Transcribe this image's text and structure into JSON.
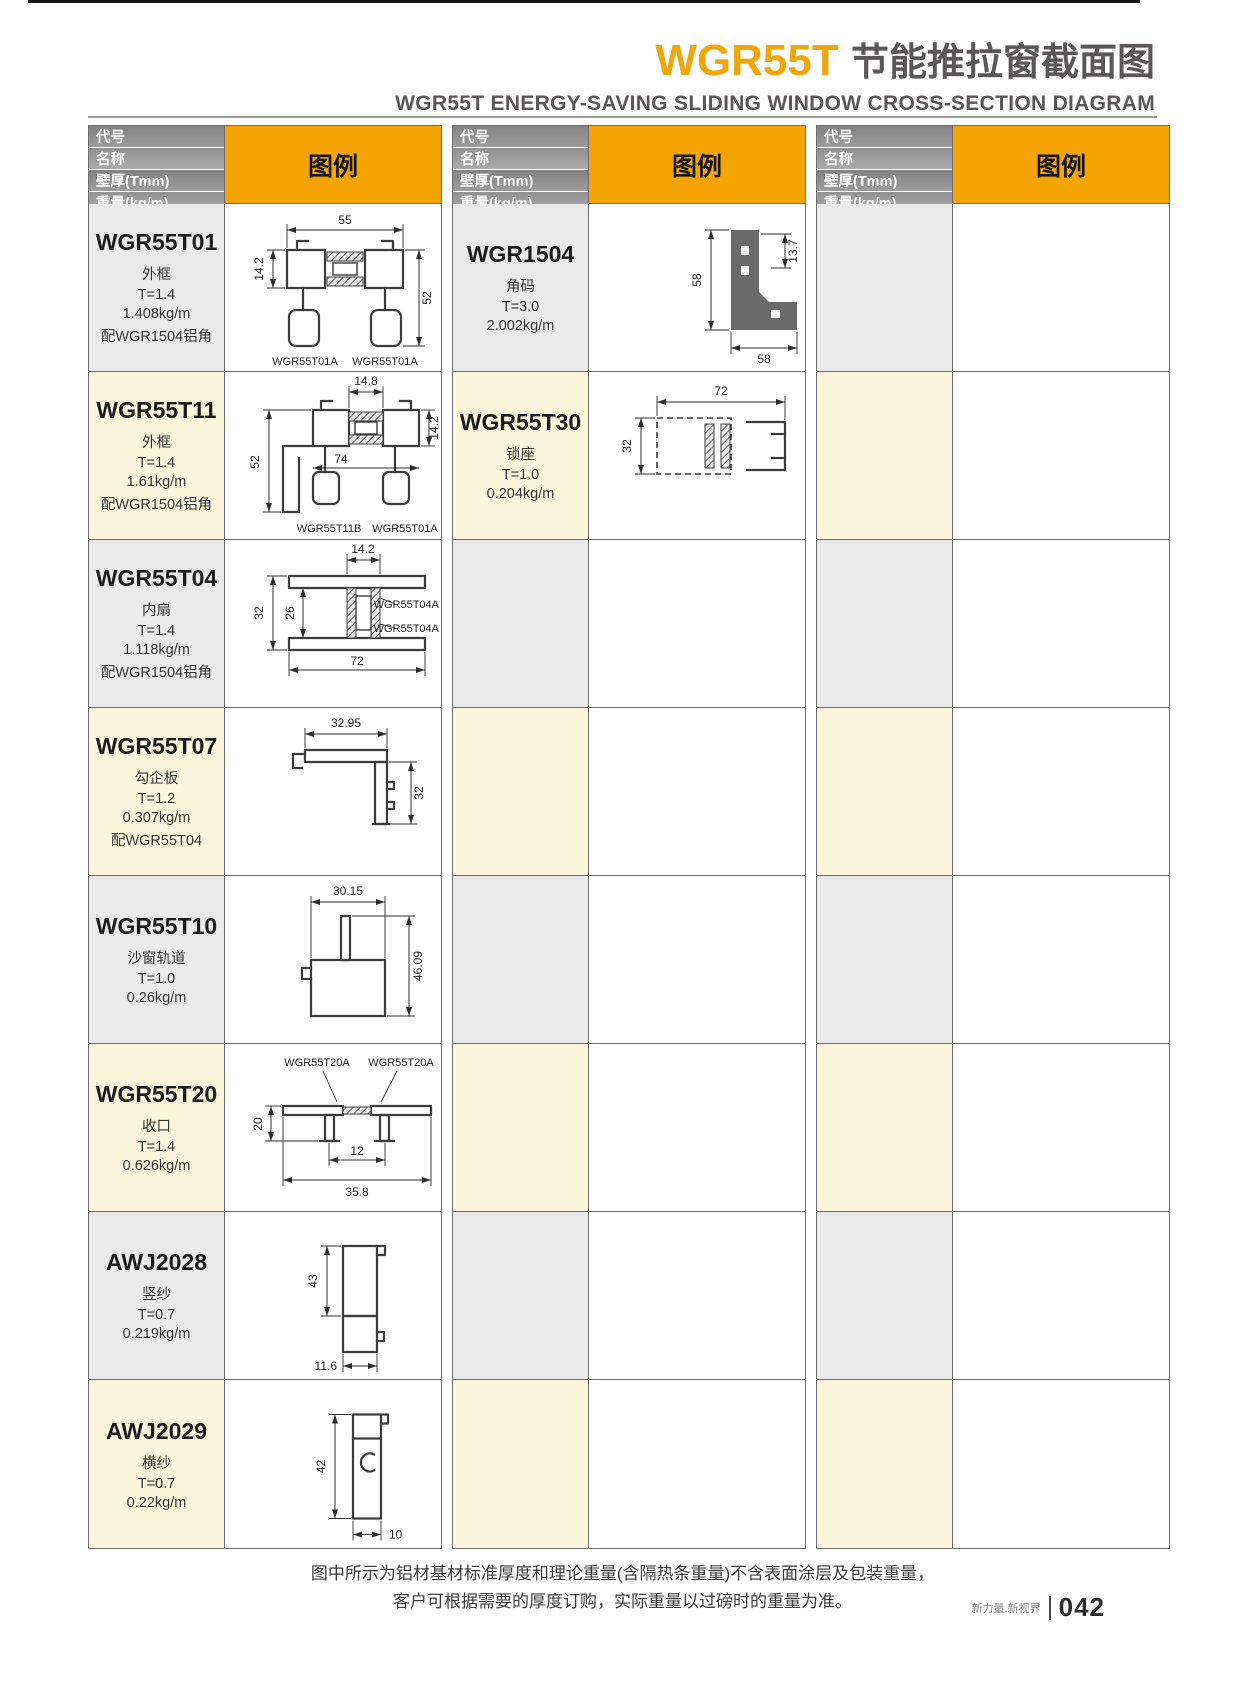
{
  "page": {
    "title_code": "WGR55T",
    "title_zh": "节能推拉窗截面图",
    "subtitle_en": "WGR55T ENERGY-SAVING SLIDING WINDOW CROSS-SECTION DIAGRAM",
    "note_line1": "图中所示为铝材基材标准厚度和理论重量(含隔热条重量)不含表面涂层及包装重量，",
    "note_line2": "客户可根据需要的厚度订购，实际重量以过磅时的重量为准。",
    "footer_brand": "新力量.新视界",
    "page_number": "042"
  },
  "colors": {
    "accent_yellow": "#F5A503",
    "title_gray": "#595757",
    "header_bar_gray": "#8f8f8f",
    "row_gray": "#EAEAEA",
    "row_cream": "#FBF6DC"
  },
  "header": {
    "code": "代号",
    "name": "名称",
    "thickness": "壁厚(Tmm)",
    "weight": "重量(kg/m)",
    "legend": "图例"
  },
  "profiles": [
    {
      "code": "WGR55T01",
      "name": "外框",
      "thickness": "T=1.4",
      "weight": "1.408kg/m",
      "note": "配WGR1504铝角",
      "dims": {
        "top": "55",
        "left": "14.2",
        "right": "52"
      },
      "sublabels": [
        "WGR55T01A",
        "WGR55T01A"
      ]
    },
    {
      "code": "WGR55T11",
      "name": "外框",
      "thickness": "T=1.4",
      "weight": "1.61kg/m",
      "note": "配WGR1504铝角",
      "dims": {
        "top": "14.8",
        "left": "52",
        "mid": "74",
        "right": "14.2"
      },
      "sublabels": [
        "WGR55T11B",
        "WGR55T01A"
      ]
    },
    {
      "code": "WGR55T04",
      "name": "内扇",
      "thickness": "T=1.4",
      "weight": "1.118kg/m",
      "note": "配WGR1504铝角",
      "dims": {
        "top": "14.2",
        "left": "32",
        "inner": "26",
        "bottom": "72"
      },
      "sublabels": [
        "WGR55T04A",
        "WGR55T04A"
      ]
    },
    {
      "code": "WGR55T07",
      "name": "勾企板",
      "thickness": "T=1.2",
      "weight": "0.307kg/m",
      "note": "配WGR55T04",
      "dims": {
        "top": "32.95",
        "right": "32"
      }
    },
    {
      "code": "WGR55T10",
      "name": "沙窗轨道",
      "thickness": "T=1.0",
      "weight": "0.26kg/m",
      "dims": {
        "top": "30.15",
        "right": "46.09"
      }
    },
    {
      "code": "WGR55T20",
      "name": "收口",
      "thickness": "T=1.4",
      "weight": "0.626kg/m",
      "dims": {
        "left": "20",
        "inner": "12",
        "bottom": "35.8"
      },
      "sublabels": [
        "WGR55T20A",
        "WGR55T20A"
      ]
    },
    {
      "code": "AWJ2028",
      "name": "竖纱",
      "thickness": "T=0.7",
      "weight": "0.219kg/m",
      "dims": {
        "left": "43",
        "bottom": "11.6"
      }
    },
    {
      "code": "AWJ2029",
      "name": "横纱",
      "thickness": "T=0.7",
      "weight": "0.22kg/m",
      "dims": {
        "left": "42",
        "bottom": "10"
      }
    },
    {
      "code": "WGR1504",
      "name": "角码",
      "thickness": "T=3.0",
      "weight": "2.002kg/m",
      "dims": {
        "left": "58",
        "right": "13.7",
        "bottom": "58"
      }
    },
    {
      "code": "WGR55T30",
      "name": "锁座",
      "thickness": "T=1.0",
      "weight": "0.204kg/m",
      "dims": {
        "top": "72",
        "left": "32"
      }
    }
  ]
}
